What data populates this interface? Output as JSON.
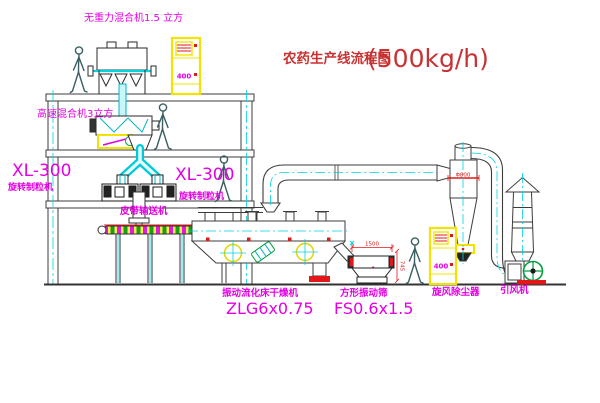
{
  "title": {
    "name": "农药生产线流程图",
    "capacity": "(500kg/h)"
  },
  "equipment_labels": {
    "gravity_mixer": "无重力混合机1.5 立方",
    "high_speed_mixer": "高速混合机3立方",
    "granulator_left_model": "XL-300",
    "granulator_left_name": "旋转制粒机",
    "granulator_right_model": "XL-300",
    "granulator_right_name": "旋转制粒机",
    "belt_conveyor": "皮带输送机",
    "dryer_name": "振动流化床干燥机",
    "dryer_model": "ZLG6x0.75",
    "screen_name": "方形振动筛",
    "screen_model": "FS0.6x1.5",
    "cyclone": "旋风除尘器",
    "fan": "引风机"
  },
  "dimensions": {
    "screen_length": "1500",
    "screen_height": "745",
    "cyclone_diameter": "Φ800",
    "cabinet_top_label": "400",
    "cabinet_right_label": "400"
  },
  "colors": {
    "line": "#3c3c3c",
    "cyan": "#00d4e0",
    "magenta": "#e400e4",
    "red": "#e01818",
    "yellow": "#f2e400",
    "green": "#009e3c",
    "title_red": "#c83232"
  }
}
